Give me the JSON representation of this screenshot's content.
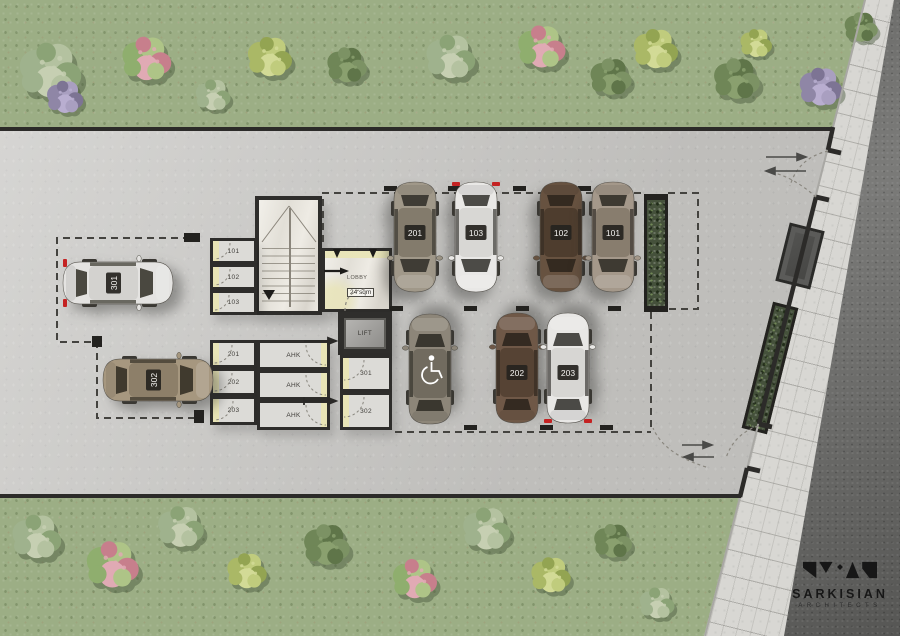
{
  "brand": {
    "name": "SARKISIAN",
    "subtitle": "ARCHITECTS"
  },
  "plan": {
    "lobby": {
      "label": "LOBBY",
      "area": "24 sqm"
    },
    "lift": {
      "label": "LIFT"
    },
    "rooms": [
      {
        "id": "storage-101",
        "label": "101",
        "x": 210,
        "y": 238,
        "w": 47,
        "h": 26,
        "door": "left"
      },
      {
        "id": "storage-102",
        "label": "102",
        "x": 210,
        "y": 264,
        "w": 47,
        "h": 26,
        "door": "left"
      },
      {
        "id": "storage-103",
        "label": "103",
        "x": 210,
        "y": 290,
        "w": 47,
        "h": 25,
        "door": "left"
      },
      {
        "id": "storage-201",
        "label": "201",
        "x": 210,
        "y": 340,
        "w": 47,
        "h": 28,
        "door": "left"
      },
      {
        "id": "storage-202",
        "label": "202",
        "x": 210,
        "y": 368,
        "w": 47,
        "h": 28,
        "door": "left"
      },
      {
        "id": "storage-203",
        "label": "203",
        "x": 210,
        "y": 396,
        "w": 47,
        "h": 29,
        "door": "left"
      },
      {
        "id": "ahk-1",
        "label": "AHK",
        "x": 257,
        "y": 340,
        "w": 73,
        "h": 30,
        "door": "right"
      },
      {
        "id": "ahk-2",
        "label": "AHK",
        "x": 257,
        "y": 370,
        "w": 73,
        "h": 30,
        "door": "right"
      },
      {
        "id": "ahk-3",
        "label": "AHK",
        "x": 257,
        "y": 400,
        "w": 73,
        "h": 30,
        "door": "right"
      },
      {
        "id": "storage-301",
        "label": "301",
        "x": 340,
        "y": 355,
        "w": 52,
        "h": 37,
        "door": "left"
      },
      {
        "id": "storage-302",
        "label": "302",
        "x": 340,
        "y": 392,
        "w": 52,
        "h": 38,
        "door": "left"
      }
    ],
    "cars": [
      {
        "label": "301",
        "cx": 118,
        "cy": 283,
        "rot": -90,
        "body": "#e4e3e1",
        "roof": "#d3d2cf",
        "glass": "#4a4840",
        "red": "top",
        "handicap": false
      },
      {
        "label": "302",
        "cx": 158,
        "cy": 380,
        "rot": -90,
        "body": "#a6977f",
        "roof": "#8d7f69",
        "glass": "#403a2e",
        "red": "",
        "handicap": false
      },
      {
        "label": "201",
        "cx": 415,
        "cy": 237,
        "rot": 0,
        "body": "#a09889",
        "roof": "#837b6c",
        "glass": "#3f3c35",
        "red": "",
        "handicap": false
      },
      {
        "label": "103",
        "cx": 476,
        "cy": 237,
        "rot": 0,
        "body": "#e9e8e6",
        "roof": "#d8d7d4",
        "glass": "#4c4b47",
        "red": "top",
        "handicap": false
      },
      {
        "label": "102",
        "cx": 561,
        "cy": 237,
        "rot": 0,
        "body": "#675240",
        "roof": "#4e3d2e",
        "glass": "#342a20",
        "red": "",
        "handicap": false
      },
      {
        "label": "101",
        "cx": 613,
        "cy": 237,
        "rot": 0,
        "body": "#a4988a",
        "roof": "#887d6e",
        "glass": "#3e3a32",
        "red": "",
        "handicap": false
      },
      {
        "label": "",
        "cx": 430,
        "cy": 369,
        "rot": 180,
        "body": "#8d8679",
        "roof": "#716b5f",
        "glass": "#3a372f",
        "red": "",
        "handicap": true
      },
      {
        "label": "202",
        "cx": 517,
        "cy": 368,
        "rot": 180,
        "body": "#6f5847",
        "roof": "#564334",
        "glass": "#342a21",
        "red": "",
        "handicap": false
      },
      {
        "label": "203",
        "cx": 568,
        "cy": 368,
        "rot": 180,
        "body": "#e8e7e5",
        "roof": "#d7d6d3",
        "glass": "#4b4a46",
        "red": "top",
        "handicap": false
      }
    ],
    "palettes": {
      "pale": [
        "#9fb28d",
        "#b4c2a0",
        "#8ba376",
        "#c6cfb2"
      ],
      "dark": [
        "#6f8657",
        "#5f7549",
        "#7c9264",
        "#8aa06f"
      ],
      "purple": [
        "#8f86a6",
        "#a99fc0",
        "#7d7494",
        "#b9aed0"
      ],
      "yellow": [
        "#aab866",
        "#c0cc7d",
        "#93a452",
        "#d2da96"
      ],
      "flowerPink": [
        "#8fae6e",
        "#aec487",
        "#c77f8c",
        "#e0aab4"
      ]
    },
    "bushes": [
      {
        "x": 52,
        "y": 72,
        "d": 78,
        "p": "pale"
      },
      {
        "x": 66,
        "y": 98,
        "d": 46,
        "p": "purple"
      },
      {
        "x": 148,
        "y": 60,
        "d": 62,
        "p": "flowerPink"
      },
      {
        "x": 214,
        "y": 96,
        "d": 44,
        "p": "pale"
      },
      {
        "x": 271,
        "y": 58,
        "d": 56,
        "p": "yellow"
      },
      {
        "x": 348,
        "y": 66,
        "d": 50,
        "p": "dark"
      },
      {
        "x": 452,
        "y": 58,
        "d": 62,
        "p": "pale"
      },
      {
        "x": 543,
        "y": 48,
        "d": 60,
        "p": "flowerPink"
      },
      {
        "x": 612,
        "y": 78,
        "d": 52,
        "p": "dark"
      },
      {
        "x": 657,
        "y": 50,
        "d": 56,
        "p": "yellow"
      },
      {
        "x": 738,
        "y": 80,
        "d": 58,
        "p": "dark"
      },
      {
        "x": 757,
        "y": 44,
        "d": 40,
        "p": "yellow"
      },
      {
        "x": 822,
        "y": 88,
        "d": 54,
        "p": "purple"
      },
      {
        "x": 862,
        "y": 28,
        "d": 42,
        "p": "dark"
      },
      {
        "x": 38,
        "y": 538,
        "d": 62,
        "p": "pale"
      },
      {
        "x": 114,
        "y": 566,
        "d": 66,
        "p": "flowerPink"
      },
      {
        "x": 182,
        "y": 528,
        "d": 58,
        "p": "pale"
      },
      {
        "x": 248,
        "y": 572,
        "d": 50,
        "p": "yellow"
      },
      {
        "x": 328,
        "y": 546,
        "d": 58,
        "p": "dark"
      },
      {
        "x": 416,
        "y": 580,
        "d": 56,
        "p": "flowerPink"
      },
      {
        "x": 488,
        "y": 530,
        "d": 60,
        "p": "pale"
      },
      {
        "x": 552,
        "y": 576,
        "d": 50,
        "p": "yellow"
      },
      {
        "x": 614,
        "y": 542,
        "d": 48,
        "p": "dark"
      },
      {
        "x": 658,
        "y": 604,
        "d": 44,
        "p": "pale"
      }
    ],
    "colors": {
      "wall": "#2e2d2b",
      "dashed_boundary": "#44433f",
      "red_marker": "#c42222",
      "bush_shadow": "#47573b"
    }
  }
}
